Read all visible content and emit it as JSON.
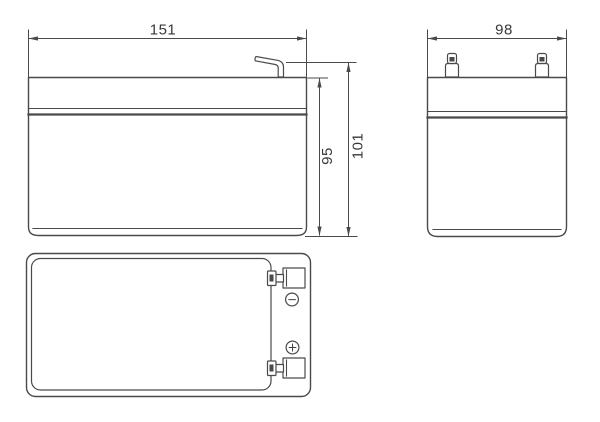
{
  "drawing": {
    "front_view": {
      "width": "151",
      "body_height": "95",
      "total_height": "101"
    },
    "side_view": {
      "depth": "98"
    },
    "top_view": {
      "negative_symbol": "−",
      "positive_symbol": "+"
    }
  },
  "colors": {
    "line": "#4a4a4a",
    "background": "#ffffff"
  }
}
